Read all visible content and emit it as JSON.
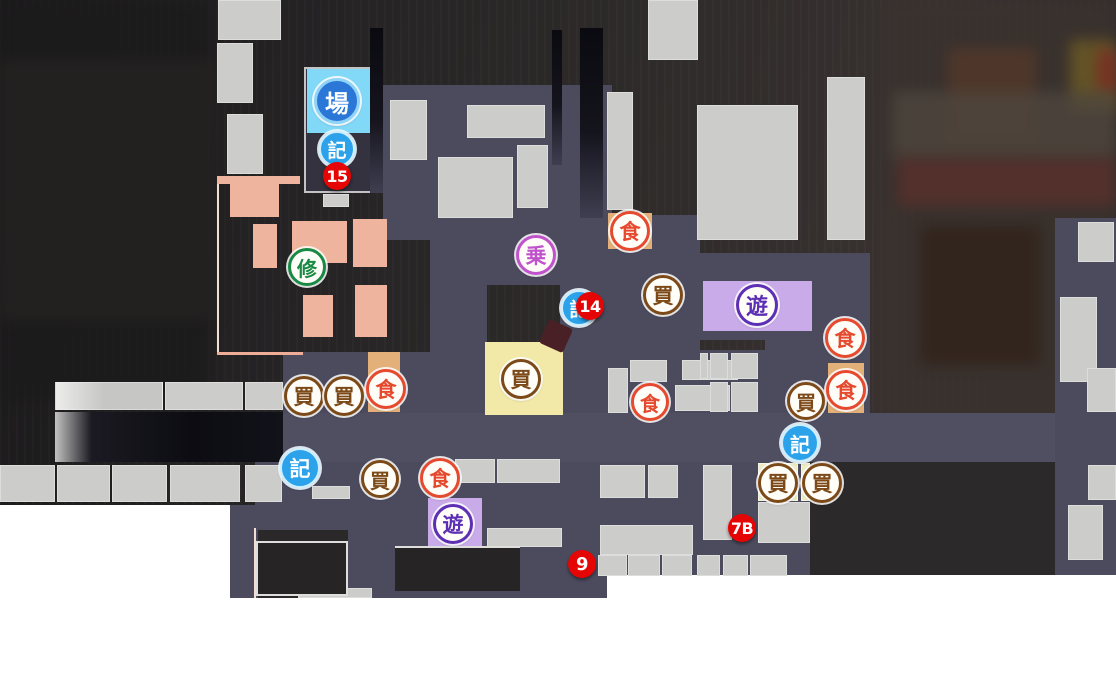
{
  "map": {
    "palette": {
      "page_background": "#ffffff",
      "road": "#4c4b5e",
      "building_gray": "#cccccb",
      "district_pink": "#efb49d",
      "highlight_yellow": "#f2e9a8",
      "highlight_cyan": "#82d8f7",
      "highlight_purple": "#c9abe9",
      "highlight_tan": "#e2b078",
      "highlight_cream": "#eeecc6",
      "marker_red": "#e60505",
      "icon_blue": "#2ba2ea"
    },
    "icon_types": {
      "restaurant": {
        "glyph": "食",
        "color": "#e64a2e",
        "style": "ring"
      },
      "shop": {
        "glyph": "買",
        "color": "#7c4a18",
        "style": "ring"
      },
      "amusement": {
        "glyph": "遊",
        "color": "#5c2fb4",
        "style": "ring"
      },
      "training": {
        "glyph": "修",
        "color": "#188a44",
        "style": "ring"
      },
      "transport": {
        "glyph": "乗",
        "color": "#c053cc",
        "style": "ring"
      },
      "save-point": {
        "glyph": "記",
        "color": "#2ba2ea",
        "style": "blue"
      },
      "venue": {
        "glyph": "場",
        "color": "#2b77d8",
        "style": "venue"
      }
    },
    "icons": [
      {
        "type": "venue",
        "x": 337,
        "y": 101,
        "d": 46
      },
      {
        "type": "save-point",
        "x": 337,
        "y": 149,
        "d": 36
      },
      {
        "type": "training",
        "x": 307,
        "y": 267,
        "d": 38
      },
      {
        "type": "transport",
        "x": 536,
        "y": 255,
        "d": 40
      },
      {
        "type": "restaurant",
        "x": 630,
        "y": 231,
        "d": 40
      },
      {
        "type": "shop",
        "x": 663,
        "y": 295,
        "d": 40
      },
      {
        "type": "amusement",
        "x": 757,
        "y": 305,
        "d": 42
      },
      {
        "type": "restaurant",
        "x": 845,
        "y": 338,
        "d": 40
      },
      {
        "type": "restaurant",
        "x": 846,
        "y": 390,
        "d": 40
      },
      {
        "type": "shop",
        "x": 806,
        "y": 401,
        "d": 38
      },
      {
        "type": "save-point",
        "x": 800,
        "y": 443,
        "d": 38
      },
      {
        "type": "shop",
        "x": 778,
        "y": 483,
        "d": 40
      },
      {
        "type": "shop",
        "x": 822,
        "y": 483,
        "d": 40
      },
      {
        "type": "save-point",
        "x": 579,
        "y": 308,
        "d": 36
      },
      {
        "type": "shop",
        "x": 521,
        "y": 379,
        "d": 40
      },
      {
        "type": "restaurant",
        "x": 650,
        "y": 402,
        "d": 38
      },
      {
        "type": "shop",
        "x": 304,
        "y": 396,
        "d": 40
      },
      {
        "type": "shop",
        "x": 344,
        "y": 396,
        "d": 40
      },
      {
        "type": "restaurant",
        "x": 386,
        "y": 389,
        "d": 40
      },
      {
        "type": "save-point",
        "x": 300,
        "y": 468,
        "d": 40
      },
      {
        "type": "shop",
        "x": 380,
        "y": 479,
        "d": 38
      },
      {
        "type": "restaurant",
        "x": 440,
        "y": 478,
        "d": 40
      },
      {
        "type": "amusement",
        "x": 453,
        "y": 524,
        "d": 40
      }
    ],
    "markers": [
      {
        "label": "15",
        "x": 337,
        "y": 176
      },
      {
        "label": "14",
        "x": 590,
        "y": 306
      },
      {
        "label": "7B",
        "x": 742,
        "y": 528
      },
      {
        "label": "9",
        "x": 582,
        "y": 564
      }
    ]
  }
}
